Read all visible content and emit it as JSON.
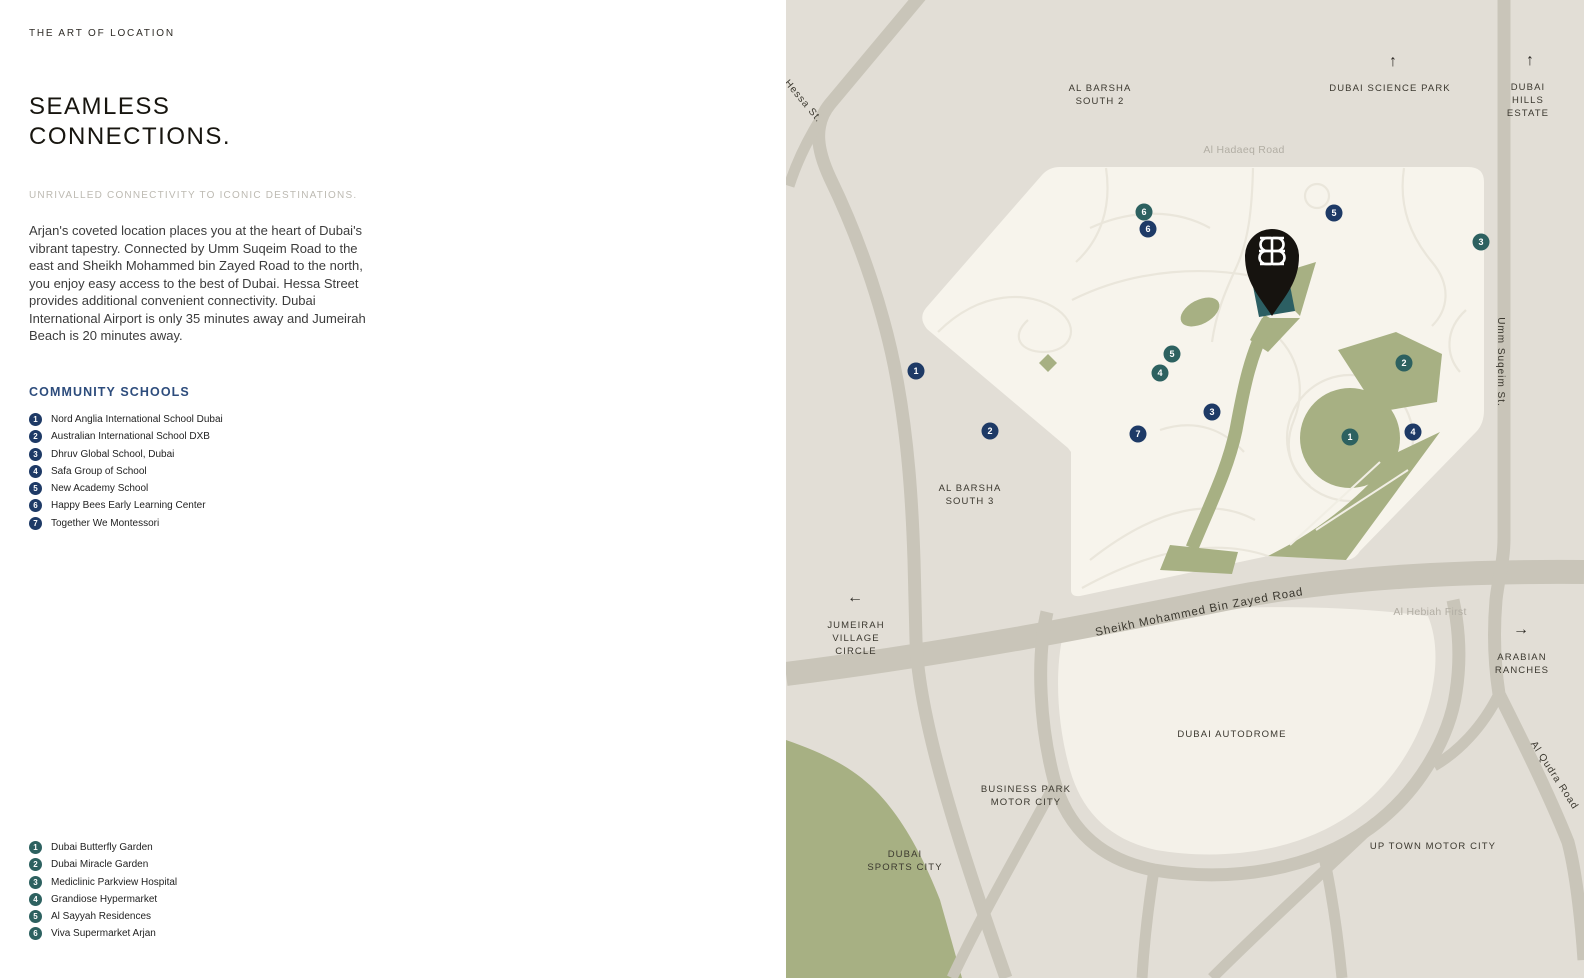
{
  "doc": {
    "eyebrow": "THE ART OF LOCATION",
    "title1": "SEAMLESS",
    "title2": "CONNECTIONS.",
    "subtitle": "UNRIVALLED CONNECTIVITY TO ICONIC DESTINATIONS.",
    "body": "Arjan's coveted location places you at the heart of Dubai's vibrant tapestry. Connected by Umm Suqeim Road to the east and Sheikh Mohammed bin Zayed Road to the north, you enjoy easy access to the best of Dubai. Hessa Street provides additional convenient connectivity. Dubai International Airport is only 35 minutes away and Jumeirah Beach is 20 minutes away."
  },
  "schools": {
    "heading": "COMMUNITY SCHOOLS",
    "marker_color": "#1e3a66",
    "items": [
      "Nord Anglia International School Dubai",
      "Australian International School DXB",
      "Dhruv Global School, Dubai",
      "Safa Group of School",
      "New Academy School",
      "Happy Bees Early Learning Center",
      "Together We Montessori"
    ]
  },
  "landmarks": {
    "marker_color": "#2d6160",
    "items": [
      "Dubai Butterfly Garden",
      "Dubai Miracle Garden",
      "Mediclinic Parkview Hospital",
      "Grandiose Hypermarket",
      "Al Sayyah Residences",
      "Viva Supermarket Arjan"
    ]
  },
  "map": {
    "colors": {
      "background": "#e2ded6",
      "community": "#f7f4ec",
      "road": "#c9c5b9",
      "sage_green": "#a7b083",
      "autodrome": "#f4f1e9",
      "pin": "#16130f",
      "project_building": "#2c5f63",
      "school_marker": "#1e3a66",
      "landmark_marker": "#2d6160"
    },
    "highway_label": "Sheikh Mohammed Bin Zayed Road",
    "area_labels": [
      {
        "name": "al-barsha-south-2",
        "lines": [
          "AL BARSHA",
          "SOUTH 2"
        ],
        "x": 1100,
        "y": 91
      },
      {
        "name": "dubai-science-park",
        "lines": [
          "DUBAI SCIENCE PARK"
        ],
        "x": 1390,
        "y": 91,
        "arrow": "↑",
        "ax": 1393,
        "ay": 66
      },
      {
        "name": "dubai-hills-estate",
        "lines": [
          "DUBAI",
          "HILLS",
          "ESTATE"
        ],
        "x": 1528,
        "y": 90,
        "arrow": "↑",
        "ax": 1530,
        "ay": 65
      },
      {
        "name": "al-barsha-south-3",
        "lines": [
          "AL BARSHA",
          "SOUTH 3"
        ],
        "x": 970,
        "y": 491
      },
      {
        "name": "jumeirah-village-circle",
        "lines": [
          "JUMEIRAH",
          "VILLAGE",
          "CIRCLE"
        ],
        "x": 856,
        "y": 628,
        "arrow": "←",
        "ax": 855,
        "ay": 602
      },
      {
        "name": "arabian-ranches",
        "lines": [
          "ARABIAN",
          "RANCHES"
        ],
        "x": 1522,
        "y": 660,
        "arrow": "→",
        "ax": 1521,
        "ay": 634
      },
      {
        "name": "dubai-autodrome",
        "lines": [
          "DUBAI AUTODROME"
        ],
        "x": 1232,
        "y": 737
      },
      {
        "name": "business-park-motor-city",
        "lines": [
          "BUSINESS PARK",
          "MOTOR CITY"
        ],
        "x": 1026,
        "y": 792
      },
      {
        "name": "dubai-sports-city",
        "lines": [
          "DUBAI",
          "SPORTS CITY"
        ],
        "x": 905,
        "y": 857
      },
      {
        "name": "up-town-motor-city",
        "lines": [
          "UP TOWN MOTOR CITY"
        ],
        "x": 1433,
        "y": 849
      }
    ],
    "road_labels": [
      {
        "name": "al-hadaeq-road",
        "text": "Al Hadaeq Road",
        "x": 1244,
        "y": 153,
        "muted": true,
        "rotate": 0
      },
      {
        "name": "al-hebiah-first",
        "text": "Al Hebiah First",
        "x": 1430,
        "y": 615,
        "muted": true,
        "rotate": 0
      },
      {
        "name": "hessa-st",
        "text": "Hessa St.",
        "x": 801,
        "y": 103,
        "muted": false,
        "rotate": 50
      },
      {
        "name": "umm-suqeim-st",
        "text": "Umm Suqeim St.",
        "x": 1498,
        "y": 362,
        "muted": false,
        "rotate": 90
      },
      {
        "name": "al-qudra-road",
        "text": "Al Qudra Road",
        "x": 1552,
        "y": 777,
        "muted": false,
        "rotate": 57
      }
    ],
    "school_markers": [
      {
        "n": "1",
        "x": 916,
        "y": 371
      },
      {
        "n": "2",
        "x": 990,
        "y": 431
      },
      {
        "n": "3",
        "x": 1212,
        "y": 412
      },
      {
        "n": "4",
        "x": 1413,
        "y": 432
      },
      {
        "n": "5",
        "x": 1334,
        "y": 213
      },
      {
        "n": "6",
        "x": 1148,
        "y": 229
      },
      {
        "n": "7",
        "x": 1138,
        "y": 434
      }
    ],
    "landmark_markers": [
      {
        "n": "1",
        "x": 1350,
        "y": 437
      },
      {
        "n": "2",
        "x": 1404,
        "y": 363
      },
      {
        "n": "3",
        "x": 1481,
        "y": 242
      },
      {
        "n": "4",
        "x": 1160,
        "y": 373
      },
      {
        "n": "5",
        "x": 1172,
        "y": 354
      },
      {
        "n": "6",
        "x": 1144,
        "y": 212
      }
    ]
  }
}
